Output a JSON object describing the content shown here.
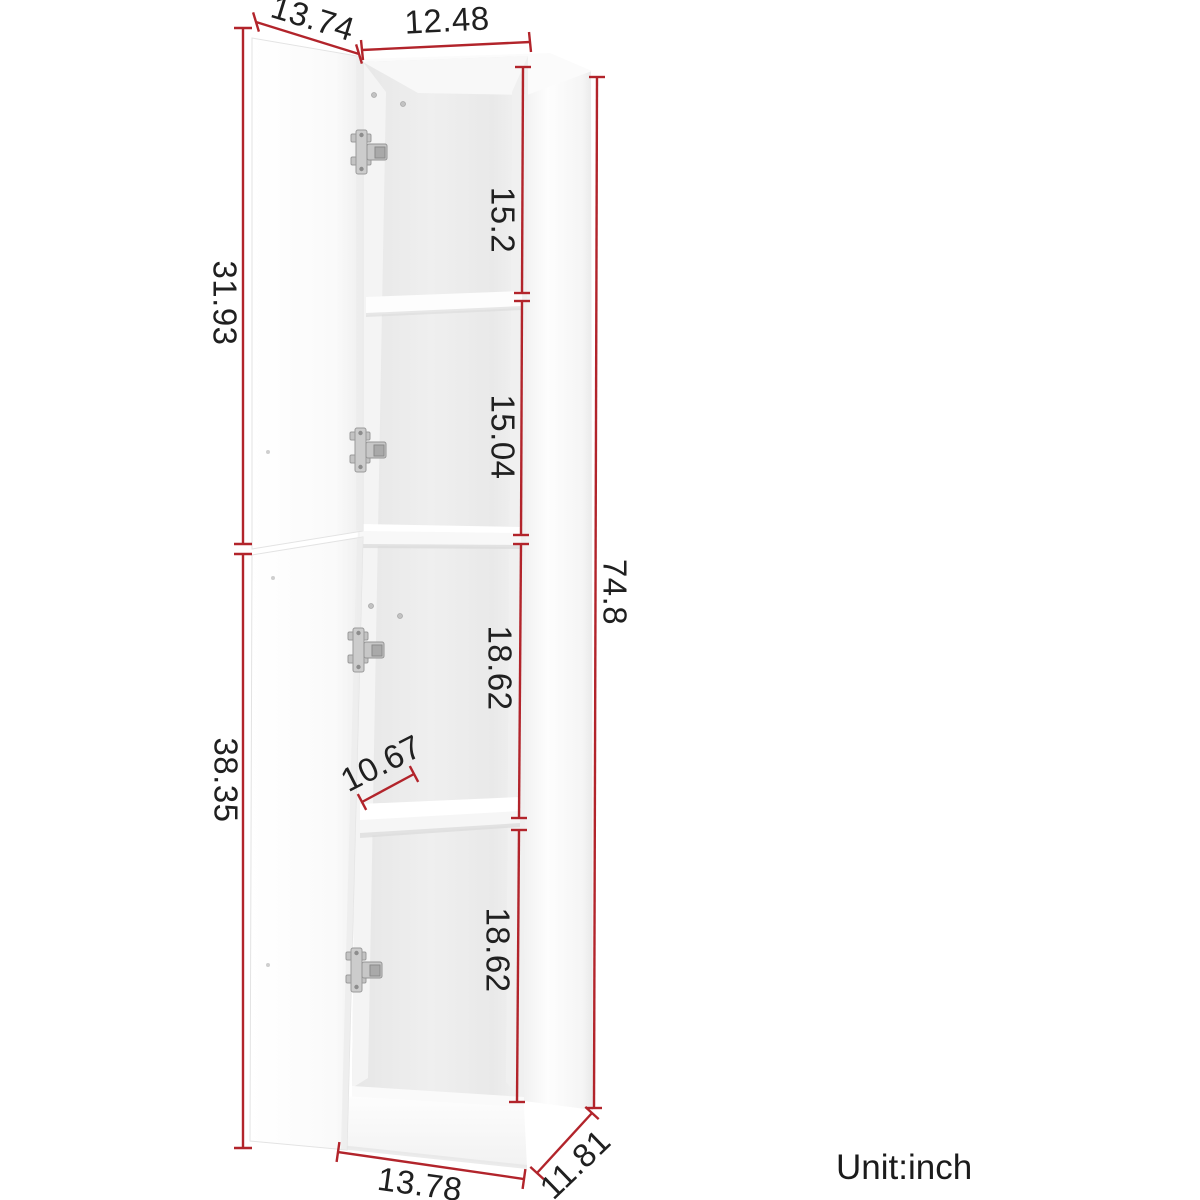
{
  "diagram": {
    "unit_label": "Unit:inch",
    "dims": {
      "top_door_width": "13.74",
      "top_width": "12.48",
      "compartment_1_height": "15.2",
      "compartment_2_height": "15.04",
      "upper_door_height": "31.93",
      "total_height": "74.8",
      "compartment_3_height": "18.62",
      "compartment_4_height": "18.62",
      "lower_door_height": "38.35",
      "shelf_depth": "10.67",
      "base_width": "13.78",
      "base_depth": "11.81"
    },
    "colors": {
      "dimension_line": "#b2242b",
      "text": "#202020",
      "cabinet_white": "#fbfbfb",
      "interior_gray": "#eaeaea",
      "background": "#ffffff"
    }
  }
}
